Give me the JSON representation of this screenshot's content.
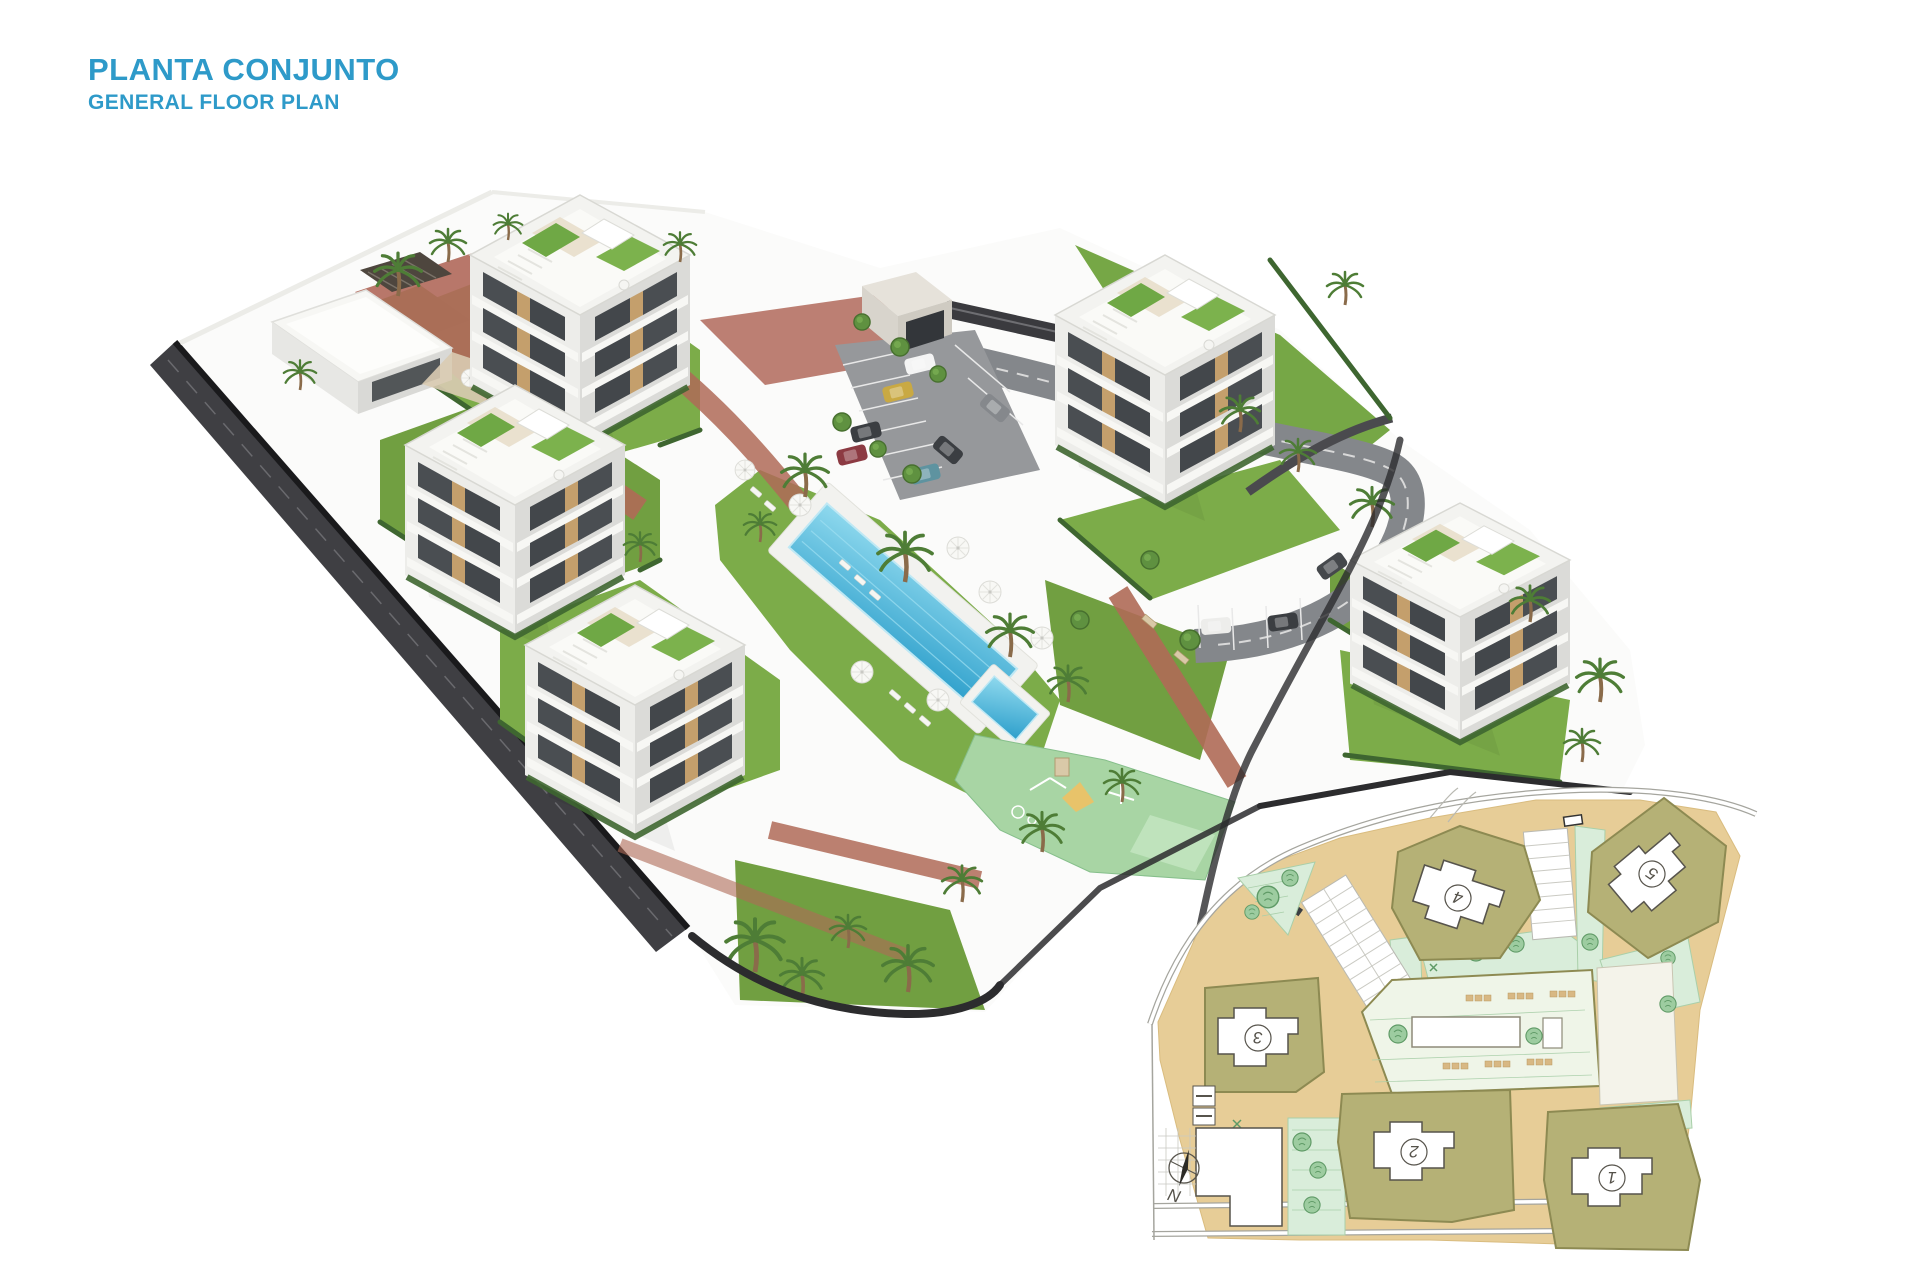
{
  "header": {
    "title": "PLANTA CONJUNTO",
    "subtitle": "GENERAL FLOOR PLAN",
    "title_color": "#2E9AC9"
  },
  "site_plan": {
    "north_label": "N",
    "buildings": [
      {
        "label": "1"
      },
      {
        "label": "2"
      },
      {
        "label": "3"
      },
      {
        "label": "4"
      },
      {
        "label": "5"
      }
    ]
  },
  "palette": {
    "title_blue": "#2E9AC9",
    "pool_light": "#8FD9EE",
    "pool_deep": "#2D9FCB",
    "lawn_green": "#7CAC49",
    "hedge_green": "#3E6630",
    "brick_path": "#AF6A57",
    "asphalt_dark": "#3F3F43",
    "asphalt_light": "#84878B",
    "building_white": "#F3F3F0",
    "building_shade": "#DBDBD8",
    "window_dark": "#4A4E52",
    "wood_accent": "#C49F6C",
    "playground_mint": "#A8D5A4",
    "plan_road_tan": "#E7CD97",
    "plan_plot_olive": "#B5B176",
    "plan_garden_green": "#D9EDDA",
    "plan_tree_green": "#9DCCA0",
    "car_gold": "#C9A943",
    "car_red": "#8C3A42",
    "car_teal": "#5E93A0"
  }
}
